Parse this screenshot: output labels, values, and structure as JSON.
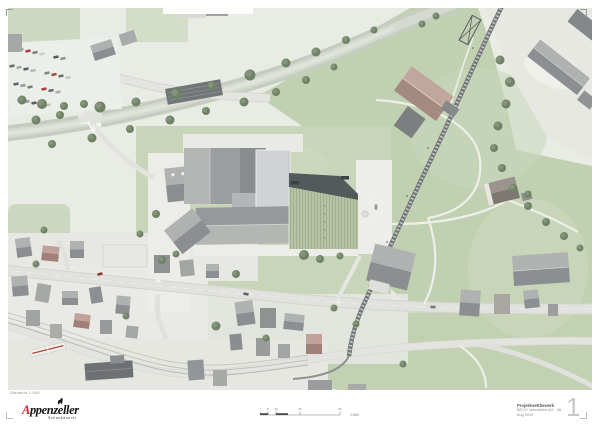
{
  "footer": {
    "caption": "Situation 1:500",
    "logo": {
      "word_first_letter": "A",
      "word_rest": "ppenzeller",
      "subline": "Schaukäserei",
      "icon": "bear-icon",
      "accent_color": "#d2232a"
    },
    "scale_bar": {
      "label": "1:500",
      "tick_labels": [
        "0",
        "5",
        "10",
        "25",
        "50"
      ]
    },
    "project_block": {
      "line1": "Projektwettbewerb",
      "line2": "BECO Immobilien AG · 26. Aug 2010"
    },
    "page_number": "1"
  },
  "colors": {
    "meadow_green": "#c6d3b6",
    "road_gray": "#e1e2dd",
    "river_gray_green": "#c5cdc0",
    "roof_dark_gray": "#8c8f91",
    "new_building_light": "#cfd3d6",
    "project_roof_green": "#b7c3a5",
    "project_roof_band": "#54595c",
    "railway_dark": "#75787a",
    "accent_red": "#d2232a",
    "page_number_gray": "#c7c7c7"
  }
}
